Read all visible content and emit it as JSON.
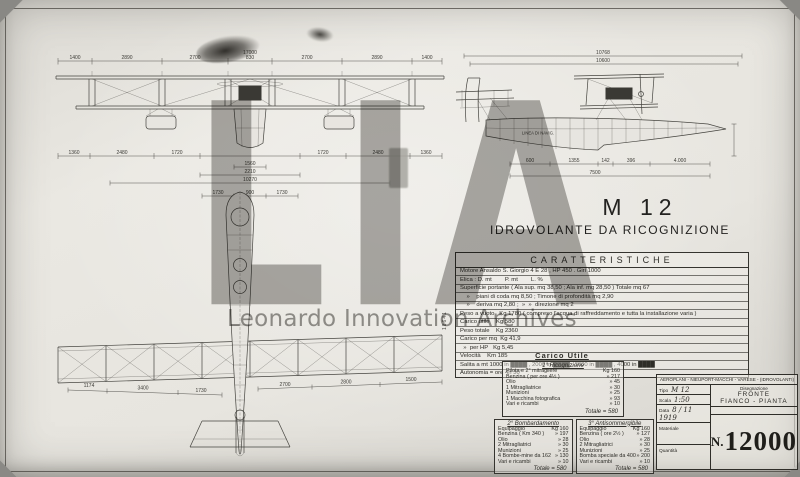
{
  "watermark": {
    "acronym": "LIA",
    "label": "Leonardo Innovation Archives"
  },
  "margin_note": "18641",
  "heading": {
    "model": "M 12",
    "subtitle": "IDROVOLANTE  DA  RICOGNIZIONE"
  },
  "front_view": {
    "total": "17000",
    "top_dims": [
      "1400",
      "2890",
      "2700",
      "830",
      "2700",
      "2890",
      "1400"
    ],
    "mid_dims": [
      "1360",
      "2480",
      "1720",
      "1720",
      "2480",
      "1360"
    ],
    "center_dims": [
      "1560",
      "2210",
      "10270"
    ],
    "lower_dims": [
      "1730",
      "900",
      "1730"
    ]
  },
  "side_view": {
    "total": "10768",
    "second": "10600",
    "hull_label": "LINEA DI NAVIG.",
    "bottom_dims": [
      "600",
      "1355",
      "142",
      "396",
      "4.000"
    ],
    "bottom_total": "7500"
  },
  "plan_view": {
    "left_dims": [
      "1174",
      "3400",
      "1730"
    ],
    "right_dims": [
      "2700",
      "2800",
      "1500"
    ]
  },
  "caratteristiche": {
    "header": "CARATTERISTICHE",
    "rows": [
      "Motore Ansaldo S. Giorgio 4 E 28 ,  HP 450 .  Giri 1000",
      "Elica :  D. mt        P. mt        L. %",
      "Superficie portante ( Ala sup. mq 38,50 ; Ala inf. mq 28,50 )  Totale  mq 67",
      "    »    piani di coda  mq 8,50 ;  Timone di profondità  mq 2,90",
      "    »    deriva  mq 2,80 ;  »  »  direzione  mq 2",
      "Peso a vuoto   Kg 1780 ( compreso l'acqua di raffreddamento e tutta la installazione varia )",
      "Carico utile    Kg 580",
      "Peso totale    Kg 2360",
      "Carico per mq  Kg 41,9",
      "  »  per HP   Kg 5,45",
      "Velocità    Km 185",
      "Salita a  mt 1000 in ████ ,  2000 in ████ ,  3000 in ████ ,  4000 in ████",
      "Autonomia =  ore 4h 30'"
    ]
  },
  "carico": {
    "title": "Carico Utile",
    "tables": [
      {
        "heading": "1° Ricognizione",
        "rows": [
          [
            "Pilota e 2° mitragliere",
            "Kg 160"
          ],
          [
            "Benzina ( per ore 4½ )",
            "» 217"
          ],
          [
            "Olio",
            "» 45"
          ],
          [
            "1 Mitragliatrice",
            "» 30"
          ],
          [
            "Munizioni",
            "» 25"
          ],
          [
            "1 Macchina fotografica",
            "» 93"
          ],
          [
            "Vari e ricambi",
            "» 10"
          ]
        ],
        "total": "Totale  = 580"
      },
      {
        "heading": "2° Bombardamento",
        "rows": [
          [
            "Equipaggio",
            "Kg 160"
          ],
          [
            "Benzina ( Km 340 )",
            "» 197"
          ],
          [
            "Olio",
            "» 28"
          ],
          [
            "2 Mitragliatrici",
            "» 30"
          ],
          [
            "Munizioni",
            "» 25"
          ],
          [
            "4 Bombe-mine da 162",
            "» 130"
          ],
          [
            "Vari e ricambi",
            "» 10"
          ]
        ],
        "total": "Totale  = 580"
      },
      {
        "heading": "3° Antisommergibile",
        "rows": [
          [
            "Equipaggio",
            "Kg 160"
          ],
          [
            "Benzina ( ore 2½ )",
            "» 127"
          ],
          [
            "Olio",
            "» 28"
          ],
          [
            "2 Mitragliatrici",
            "» 30"
          ],
          [
            "Munizioni",
            "» 25"
          ],
          [
            "Bomba speciale da 400",
            "» 200"
          ],
          [
            "Vari e ricambi",
            "» 10"
          ]
        ],
        "total": "Totale  = 580"
      }
    ]
  },
  "title_block": {
    "header": "AEROPLANI - NIEUPORT-MACCHI - VARESE - (IDROVOLANTI)",
    "fields": [
      [
        "Tipo",
        "M 12"
      ],
      [
        "Scala",
        "1:50"
      ],
      [
        "Data",
        "8 / 11  1919"
      ],
      [
        "Materiale",
        ""
      ],
      [
        "Quantità",
        ""
      ]
    ],
    "drawing_label": "Disegnazione",
    "drawing_value_1": "FRONTE",
    "drawing_value_2": "FIANCO - PIANTA",
    "number_prefix": "N.",
    "number_value": "12000"
  }
}
